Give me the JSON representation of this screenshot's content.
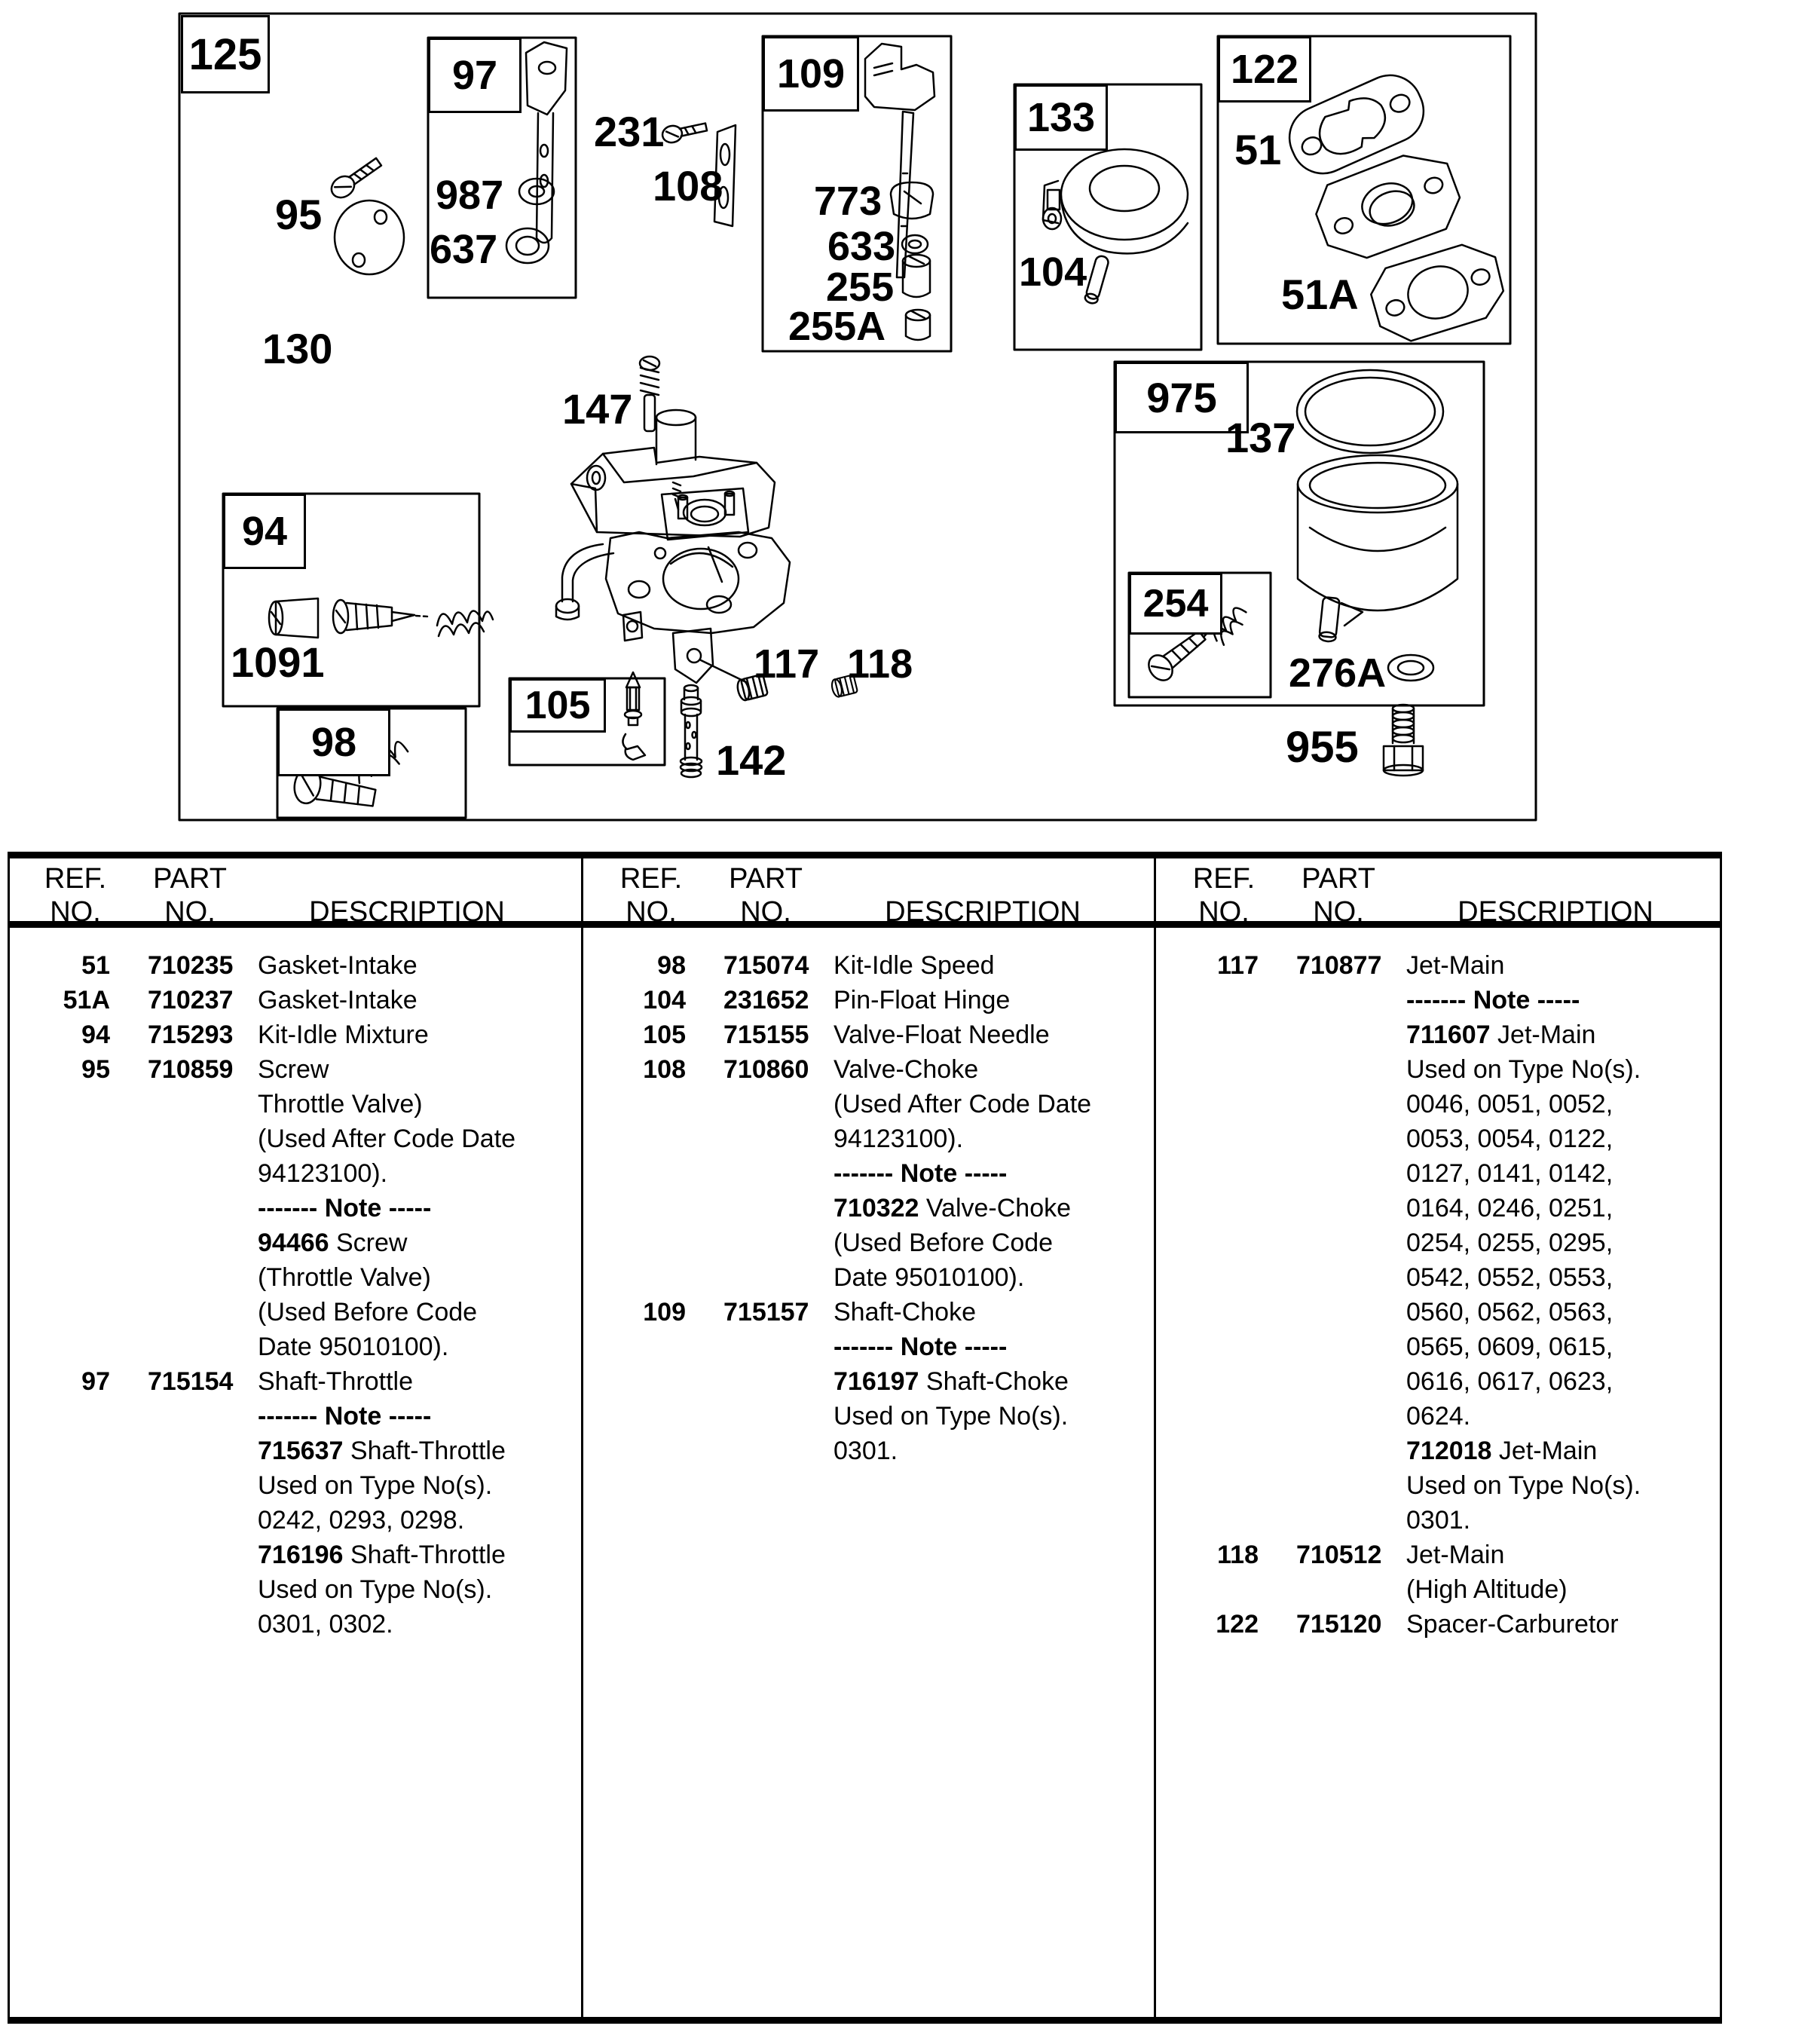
{
  "colors": {
    "ink": "#000000",
    "paper": "#ffffff"
  },
  "diagram": {
    "callouts": {
      "n125": "125",
      "n95": "95",
      "n130": "130",
      "n97": "97",
      "n987": "987",
      "n637": "637",
      "n231": "231",
      "n108": "108",
      "n109": "109",
      "n773": "773",
      "n633": "633",
      "n255": "255",
      "n255A": "255A",
      "n133": "133",
      "n104": "104",
      "n122": "122",
      "n51": "51",
      "n51A": "51A",
      "n147": "147",
      "n94": "94",
      "n1091": "1091",
      "n98": "98",
      "n105": "105",
      "n117": "117",
      "n118": "118",
      "n142": "142",
      "n975": "975",
      "n137": "137",
      "n254": "254",
      "n276A": "276A",
      "n955": "955"
    }
  },
  "table": {
    "headers": {
      "ref1": "REF.",
      "ref2": "NO.",
      "part1": "PART",
      "part2": "NO.",
      "desc": "DESCRIPTION"
    },
    "columns": [
      {
        "rows": [
          {
            "ref": "51",
            "part": "710235",
            "desc": [
              {
                "t": "Gasket-Intake"
              }
            ]
          },
          {
            "ref": "51A",
            "part": "710237",
            "desc": [
              {
                "t": "Gasket-Intake"
              }
            ]
          },
          {
            "ref": "94",
            "part": "715293",
            "desc": [
              {
                "t": "Kit-Idle Mixture"
              }
            ]
          },
          {
            "ref": "95",
            "part": "710859",
            "desc": [
              {
                "t": "Screw"
              },
              {
                "t": "Throttle Valve)"
              },
              {
                "t": "(Used After Code Date"
              },
              {
                "t": "94123100)."
              },
              {
                "b": "------- Note -----"
              },
              {
                "b": "94466 ",
                "t": "Screw"
              },
              {
                "t": "(Throttle Valve)"
              },
              {
                "t": "(Used Before Code"
              },
              {
                "t": "Date 95010100)."
              }
            ]
          },
          {
            "ref": "97",
            "part": "715154",
            "desc": [
              {
                "t": "Shaft-Throttle"
              },
              {
                "b": "------- Note -----"
              },
              {
                "b": "715637 ",
                "t": "Shaft-Throttle"
              },
              {
                "t": "Used on Type No(s)."
              },
              {
                "t": "0242, 0293, 0298."
              },
              {
                "b": "716196 ",
                "t": "Shaft-Throttle"
              },
              {
                "t": "Used on Type No(s)."
              },
              {
                "t": "0301, 0302."
              }
            ]
          }
        ]
      },
      {
        "rows": [
          {
            "ref": "98",
            "part": "715074",
            "desc": [
              {
                "t": "Kit-Idle Speed"
              }
            ]
          },
          {
            "ref": "104",
            "part": "231652",
            "desc": [
              {
                "t": "Pin-Float Hinge"
              }
            ]
          },
          {
            "ref": "105",
            "part": "715155",
            "desc": [
              {
                "t": "Valve-Float Needle"
              }
            ]
          },
          {
            "ref": "108",
            "part": "710860",
            "desc": [
              {
                "t": "Valve-Choke"
              },
              {
                "t": "(Used After Code Date"
              },
              {
                "t": "94123100)."
              },
              {
                "b": "------- Note -----"
              },
              {
                "b": "710322 ",
                "t": "Valve-Choke"
              },
              {
                "t": "(Used Before Code"
              },
              {
                "t": "Date 95010100)."
              }
            ]
          },
          {
            "ref": "109",
            "part": "715157",
            "desc": [
              {
                "t": "Shaft-Choke"
              },
              {
                "b": "------- Note -----"
              },
              {
                "b": "716197 ",
                "t": "Shaft-Choke"
              },
              {
                "t": "Used on Type No(s)."
              },
              {
                "t": "0301."
              }
            ]
          }
        ]
      },
      {
        "rows": [
          {
            "ref": "117",
            "part": "710877",
            "desc": [
              {
                "t": "Jet-Main"
              },
              {
                "b": "------- Note -----"
              },
              {
                "b": "711607 ",
                "t": "Jet-Main"
              },
              {
                "t": "Used on Type No(s)."
              },
              {
                "t": "0046, 0051, 0052,"
              },
              {
                "t": "0053, 0054, 0122,"
              },
              {
                "t": "0127, 0141, 0142,"
              },
              {
                "t": "0164, 0246, 0251,"
              },
              {
                "t": "0254, 0255, 0295,"
              },
              {
                "t": "0542, 0552, 0553,"
              },
              {
                "t": "0560, 0562, 0563,"
              },
              {
                "t": "0565, 0609, 0615,"
              },
              {
                "t": "0616, 0617, 0623,"
              },
              {
                "t": "0624."
              },
              {
                "b": "712018 ",
                "t": "Jet-Main"
              },
              {
                "t": "Used on Type No(s)."
              },
              {
                "t": "0301."
              }
            ]
          },
          {
            "ref": "118",
            "part": "710512",
            "desc": [
              {
                "t": "Jet-Main"
              },
              {
                "t": "(High Altitude)"
              }
            ]
          },
          {
            "ref": "122",
            "part": "715120",
            "desc": [
              {
                "t": "Spacer-Carburetor"
              }
            ]
          }
        ]
      }
    ]
  }
}
